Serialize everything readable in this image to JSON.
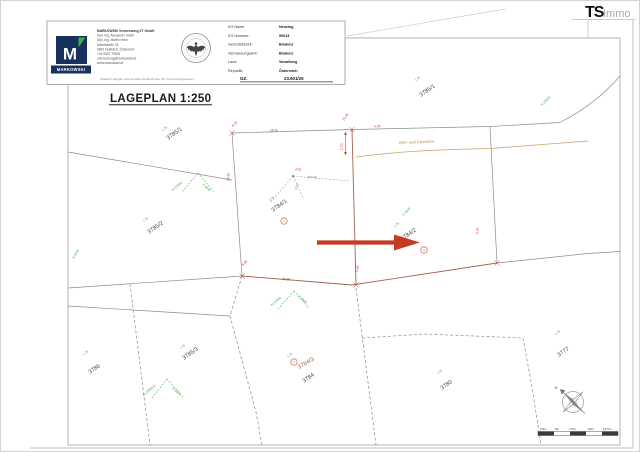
{
  "ts_logo": {
    "ts": "TS",
    "immo": "Immo"
  },
  "header": {
    "brand": "MARKOWSKI",
    "brand_monogram": "M",
    "company_lines": [
      "MARKOWSKI Vermessung ZT GmbH",
      "Dipl.-Ing. Alexander Strobl",
      "Dipl.-Ing. Martin Heim",
      "Marktstraße 33",
      "6800 Feldkirch, Österreich",
      "+43 5522 79825",
      "vermessung@markowski.at",
      "www.markowski.at"
    ],
    "disclaimer": "Staatlich befugte und beeidete Ziviltechniker für Vermessungswesen",
    "fields": [
      {
        "label": "KG Name:",
        "value": "Nenzing"
      },
      {
        "label": "KG Nummer:",
        "value": "90013"
      },
      {
        "label": "Gerichtsbezirk:",
        "value": "Bludenz"
      },
      {
        "label": "Vermessungsamt:",
        "value": "Bludenz"
      },
      {
        "label": "Land:",
        "value": "Vorarlberg"
      },
      {
        "label": "Republik:",
        "value": "Österreich"
      }
    ],
    "gz_label": "GZ.",
    "gz_value": "23.601/25",
    "seal_icon": "austrian-eagle-seal"
  },
  "title": "LAGEPLAN 1:250",
  "map": {
    "ln_label": "L.N",
    "servitude_label": "Geh- und Fahrrecht",
    "point_label": "P37",
    "tie_note": "(25.78)",
    "tie_note2": "(2.5)",
    "parcels": [
      {
        "number": "3785/1"
      },
      {
        "number": "3785/1"
      },
      {
        "number": "3785/2"
      },
      {
        "number": "3784/1"
      },
      {
        "number": "3784/2"
      },
      {
        "number": "3785/3"
      },
      {
        "number": "3786"
      },
      {
        "number": "3784/3"
      },
      {
        "number": "3784"
      },
      {
        "number": "3780"
      },
      {
        "number": "3777"
      }
    ],
    "green_refs": [
      "N 23609",
      "P 4049",
      "N 23609",
      "P 4049",
      "N 23609-G",
      "P 4905",
      "P 4049",
      "N 23609",
      "N 4046"
    ],
    "dimensions": [
      "25.92",
      "20.45",
      "4.30",
      "6.20",
      "2.70",
      "29.20",
      "25.96",
      "6.80",
      "6.60",
      "5.80"
    ],
    "point_markers": [
      "1",
      "1",
      "1"
    ],
    "compass_label": "N",
    "scale_labels": [
      "2.5m",
      "5m",
      "7.5m",
      "10m",
      "12.5m"
    ]
  },
  "colors": {
    "accent_red": "#c23b22",
    "boundary_brown": "#a2604e",
    "servitude_tan": "#c9a26b",
    "survey_green": "#46a546",
    "brand_navy": "#16325c",
    "brand_green": "#3fae49"
  }
}
